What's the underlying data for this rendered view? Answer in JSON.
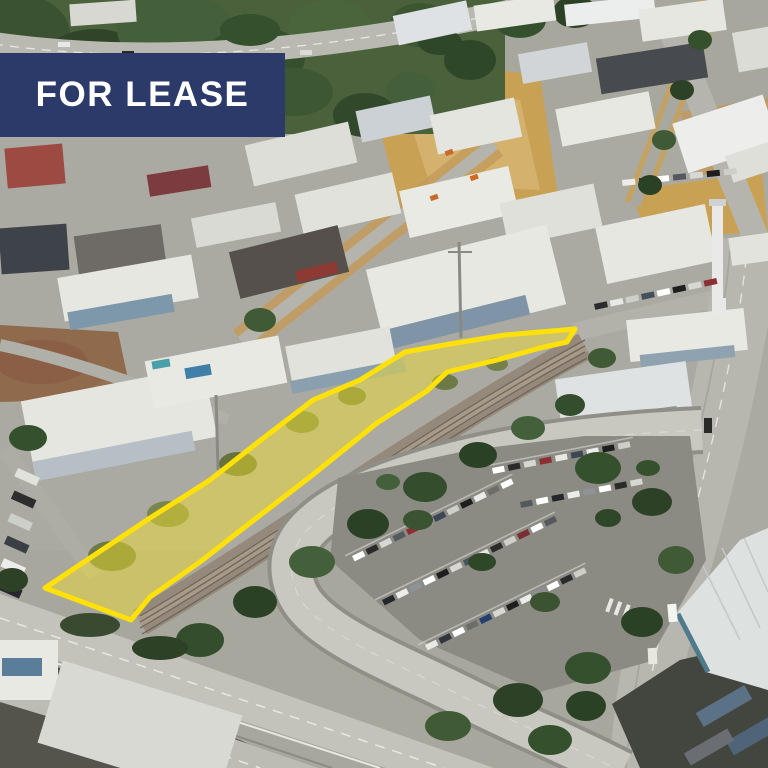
{
  "banner": {
    "label": "FOR LEASE",
    "background_color": "#2b3a69",
    "text_color": "#ffffff"
  },
  "parcel": {
    "points": "45,588 150,518 210,480 257,443 313,400 360,380 405,352 450,344 505,335 575,329 567,342 540,348 497,360 447,372 427,391 377,423 310,477 250,523 200,562 150,597 131,620",
    "fill_color": "#f7e32b",
    "fill_opacity": "0.45",
    "outline_color": "#ffe10a",
    "outline_width": "5"
  }
}
